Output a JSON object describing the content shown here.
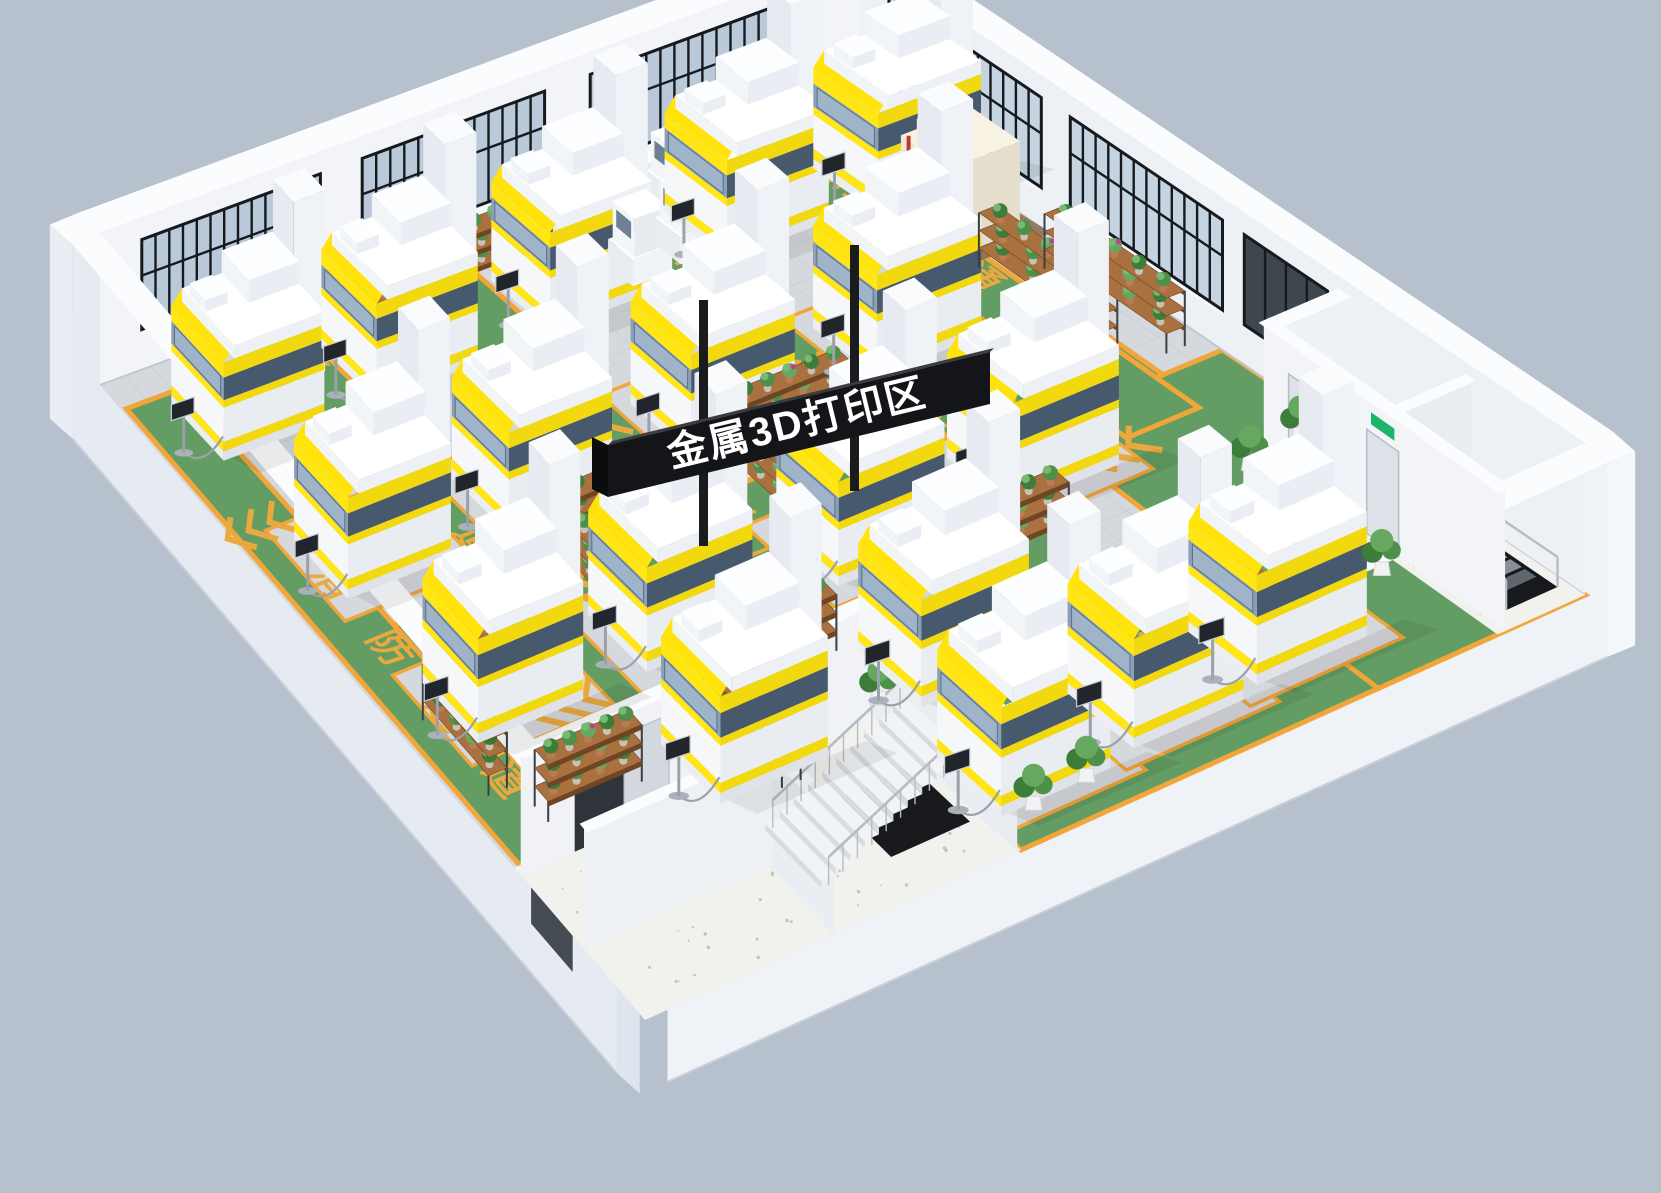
{
  "title": "金属3D打印区",
  "sign": {
    "text": "金属3D打印区",
    "panel_color": "#141518",
    "text_color": "#ffffff",
    "pole_color": "#1a1b1d"
  },
  "floor_marking": {
    "label": "消防通道",
    "chars": [
      "消",
      "防",
      "通",
      "道"
    ],
    "arrow": "<<<",
    "text_color": "#eaa93f",
    "lane_color": "#639d63",
    "border_color": "#f2a63a"
  },
  "palette": {
    "background": "#b7c1ce",
    "floor": "#d5d8dc",
    "grout": "#c7cbd1",
    "green": "#639d63",
    "border": "#f2a63a",
    "marking": "#eaa93f",
    "wall_nw": "#f2f4f7",
    "wall_ne": "#edf0f4",
    "wall_top": "#fbfcfd",
    "ext_sw": "#e6ebf2",
    "ext_se": "#eff2f7",
    "glass_nw": "#b9c9da",
    "glass_ne": "#c6d4e1",
    "glass_dark": "#3e464e",
    "glass_se": "#23272c",
    "mull": "#16191e",
    "concrete": "#f1f1ee",
    "machine_yellow": "#ffe614",
    "machine_yellow_front": "#f2d80f",
    "window_left": "#8ba0b7",
    "window_front": "#47596d",
    "exit_green": "#1db56b",
    "wood": "#a9713f",
    "wood_side": "#6f4523",
    "rack_frame": "#3a3f45",
    "rail": "#b6bcc4",
    "hole": "#17191d"
  },
  "scene": {
    "quad": [
      [
        100,
        385
      ],
      [
        860,
        105
      ],
      [
        1585,
        595
      ],
      [
        645,
        1020
      ]
    ],
    "wall_h": 152,
    "nw_windows": [
      [
        0.055,
        0.29
      ],
      [
        0.345,
        0.585
      ],
      [
        0.645,
        0.885
      ]
    ],
    "ne_windows": [
      [
        0.04,
        0.25
      ],
      [
        0.29,
        0.5
      ]
    ],
    "ne_dark_window": [
      0.53,
      0.645
    ],
    "se_strip": [
      0.45,
      0.88
    ],
    "se_squares": [
      [
        0.905,
        0.933
      ],
      [
        0.945,
        0.973
      ]
    ],
    "bl_window": [
      0.1,
      0.28
    ],
    "sw_door": [
      0.84,
      0.92
    ],
    "aisles": [
      {
        "c": 0.042,
        "w": 0.036,
        "b1": 0.04,
        "b2": 0.78,
        "chars": [
          0.34,
          0.445,
          0.55,
          0.655
        ],
        "chev": [
          0.24
        ]
      },
      {
        "c": 0.205,
        "w": 0.042,
        "b1": 0.02,
        "b2": 0.76,
        "chars": [
          0.06,
          0.16,
          0.26,
          0.36
        ],
        "chev": [
          0.5
        ]
      },
      {
        "c": 0.425,
        "w": 0.042,
        "b1": 0.02,
        "b2": 0.74,
        "chars": [
          0.44,
          0.53,
          0.62,
          0.71
        ],
        "chev": [
          0.28
        ]
      },
      {
        "c": 0.66,
        "w": 0.042,
        "b1": 0.02,
        "b2": 0.86,
        "chars": [
          0.12,
          0.21
        ],
        "chev": [
          0.32
        ]
      },
      {
        "c": 0.88,
        "w": 0.042,
        "b1": 0.03,
        "b2": 0.56,
        "chars": [
          0.1,
          0.19,
          0.28,
          0.37
        ],
        "chev": []
      }
    ],
    "uaisles": [
      {
        "c": 0.46,
        "w": 0.04,
        "a1": 0.02,
        "a2": 0.93,
        "chars": [
          0.7,
          0.62,
          0.54,
          0.46
        ],
        "chev": [
          0.24,
          0.78
        ]
      },
      {
        "c": 0.6,
        "w": 0.038,
        "a1": 0.02,
        "a2": 0.62,
        "chars": [],
        "chev": [
          0.15
        ]
      }
    ],
    "zones": [
      [
        [
          0.4,
          0.78
        ],
        [
          1,
          0.78
        ],
        [
          1,
          1
        ],
        [
          0.4,
          1
        ]
      ],
      [
        [
          0.78,
          0.5
        ],
        [
          1,
          0.5
        ],
        [
          1,
          1
        ],
        [
          0.78,
          1
        ]
      ]
    ],
    "zone_chars": {
      "b": 0.865,
      "as": [
        0.63,
        0.555,
        0.48,
        0.405
      ]
    },
    "zone_chev": [
      [
        0.64,
        0.83
      ],
      [
        0.35,
        0.895
      ],
      [
        0.8,
        0.57
      ]
    ],
    "machines": [
      [
        0.12,
        0.1
      ],
      [
        0.315,
        0.1
      ],
      [
        0.54,
        0.095
      ],
      [
        0.77,
        0.09
      ],
      [
        0.12,
        0.32
      ],
      [
        0.315,
        0.32
      ],
      [
        0.54,
        0.315
      ],
      [
        0.77,
        0.31
      ],
      [
        0.12,
        0.55
      ],
      [
        0.315,
        0.55
      ],
      [
        0.54,
        0.545
      ],
      [
        0.745,
        0.54
      ],
      [
        0.27,
        0.74
      ],
      [
        0.5,
        0.73
      ],
      [
        0.47,
        0.9
      ],
      [
        0.62,
        0.89
      ],
      [
        0.76,
        0.88
      ],
      [
        0.95,
        0.105
      ]
    ],
    "smalls": [
      [
        0.6,
        0.045
      ],
      [
        0.665,
        0.04
      ],
      [
        0.73,
        0.035
      ],
      [
        0.62,
        0.105
      ],
      [
        0.685,
        0.1
      ],
      [
        0.75,
        0.095
      ]
    ],
    "cmm": [
      0.935,
      0.21
    ],
    "racks": [
      {
        "o": "u",
        "l": 130,
        "a": 0.25,
        "b": 0.03
      },
      {
        "o": "u",
        "l": 115,
        "a": 0.42,
        "b": 0.028
      },
      {
        "o": "u",
        "l": 115,
        "a": 0.78,
        "b": 0.022
      },
      {
        "o": "v",
        "l": 150,
        "a": 0.905,
        "b": 0.27
      },
      {
        "o": "v",
        "l": 150,
        "a": 0.955,
        "b": 0.305
      },
      {
        "o": "u",
        "l": 120,
        "a": 0.29,
        "b": 0.4
      },
      {
        "o": "v",
        "l": 105,
        "a": 0.265,
        "b": 0.425
      },
      {
        "o": "u",
        "l": 120,
        "a": 0.515,
        "b": 0.37
      },
      {
        "o": "v",
        "l": 105,
        "a": 0.49,
        "b": 0.395
      },
      {
        "o": "u",
        "l": 110,
        "a": 0.052,
        "b": 0.52
      },
      {
        "o": "v",
        "l": 100,
        "a": 0.03,
        "b": 0.545
      },
      {
        "o": "u",
        "l": 120,
        "a": 0.295,
        "b": 0.645
      },
      {
        "o": "v",
        "l": 110,
        "a": 0.27,
        "b": 0.67
      },
      {
        "o": "u",
        "l": 115,
        "a": 0.575,
        "b": 0.63
      },
      {
        "o": "v",
        "l": 105,
        "a": 0.55,
        "b": 0.655
      },
      {
        "o": "v",
        "l": 130,
        "a": 0.78,
        "b": 0.73
      },
      {
        "o": "u",
        "l": 100,
        "a": 0.06,
        "b": 0.7
      }
    ],
    "plants": [
      [
        0.895,
        0.665
      ],
      [
        0.9,
        0.76
      ],
      [
        0.885,
        0.865
      ],
      [
        0.96,
        0.655
      ],
      [
        0.41,
        0.755
      ],
      [
        0.44,
        0.96
      ],
      [
        0.5,
        0.955
      ]
    ],
    "tr": {
      "a0": 0.915,
      "b0": 0.66,
      "div": 0.835,
      "door_dbl": [
        0.695,
        0.775
      ],
      "door_sgl": [
        0.805,
        0.85
      ],
      "hole": [
        0.935,
        0.875,
        0.99,
        0.975
      ],
      "h": 140
    },
    "bl": {
      "a1": 0.4,
      "b0": 0.76,
      "part_a": 0.205,
      "part_b": 0.88,
      "door": [
        0.06,
        0.115
      ],
      "stair": {
        "a0": 0.225,
        "da": 0.0155,
        "n": 10,
        "b0": 0.845,
        "b1": 0.94
      },
      "hole": [
        0.3,
        0.845,
        0.385,
        0.94
      ],
      "h": 120
    }
  }
}
